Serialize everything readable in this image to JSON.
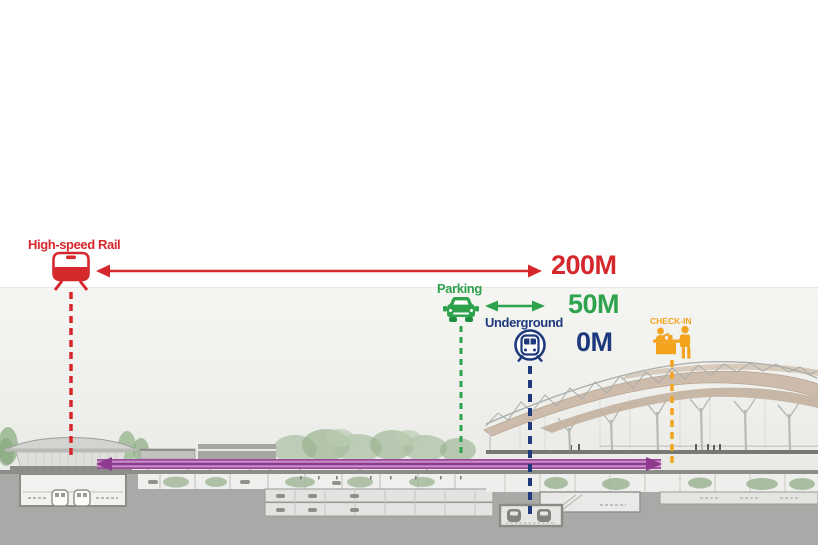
{
  "annotations": {
    "high_speed_rail": {
      "label": "High-speed Rail",
      "distance": "200M",
      "color": "#d5282d",
      "icon": "train-front-icon"
    },
    "parking": {
      "label": "Parking",
      "distance": "50M",
      "color": "#2fa24e",
      "icon": "car-icon"
    },
    "underground": {
      "label": "Underground",
      "distance": "0M",
      "color": "#1e3a7c",
      "icon": "metro-circle-icon"
    },
    "check_in": {
      "label": "CHECK-IN",
      "color": "#f2a41f",
      "icon": "check-in-desk-icon"
    }
  },
  "scene_colors": {
    "apm_corridor_arrow": "#8e3a8e",
    "apm_corridor_band": "#c990c7",
    "earth": "#a9a9a7",
    "sky_band": "#f2f2ef",
    "terminal_roof_shell": "#cdbcab",
    "structure_gray": "#8c8c89"
  }
}
